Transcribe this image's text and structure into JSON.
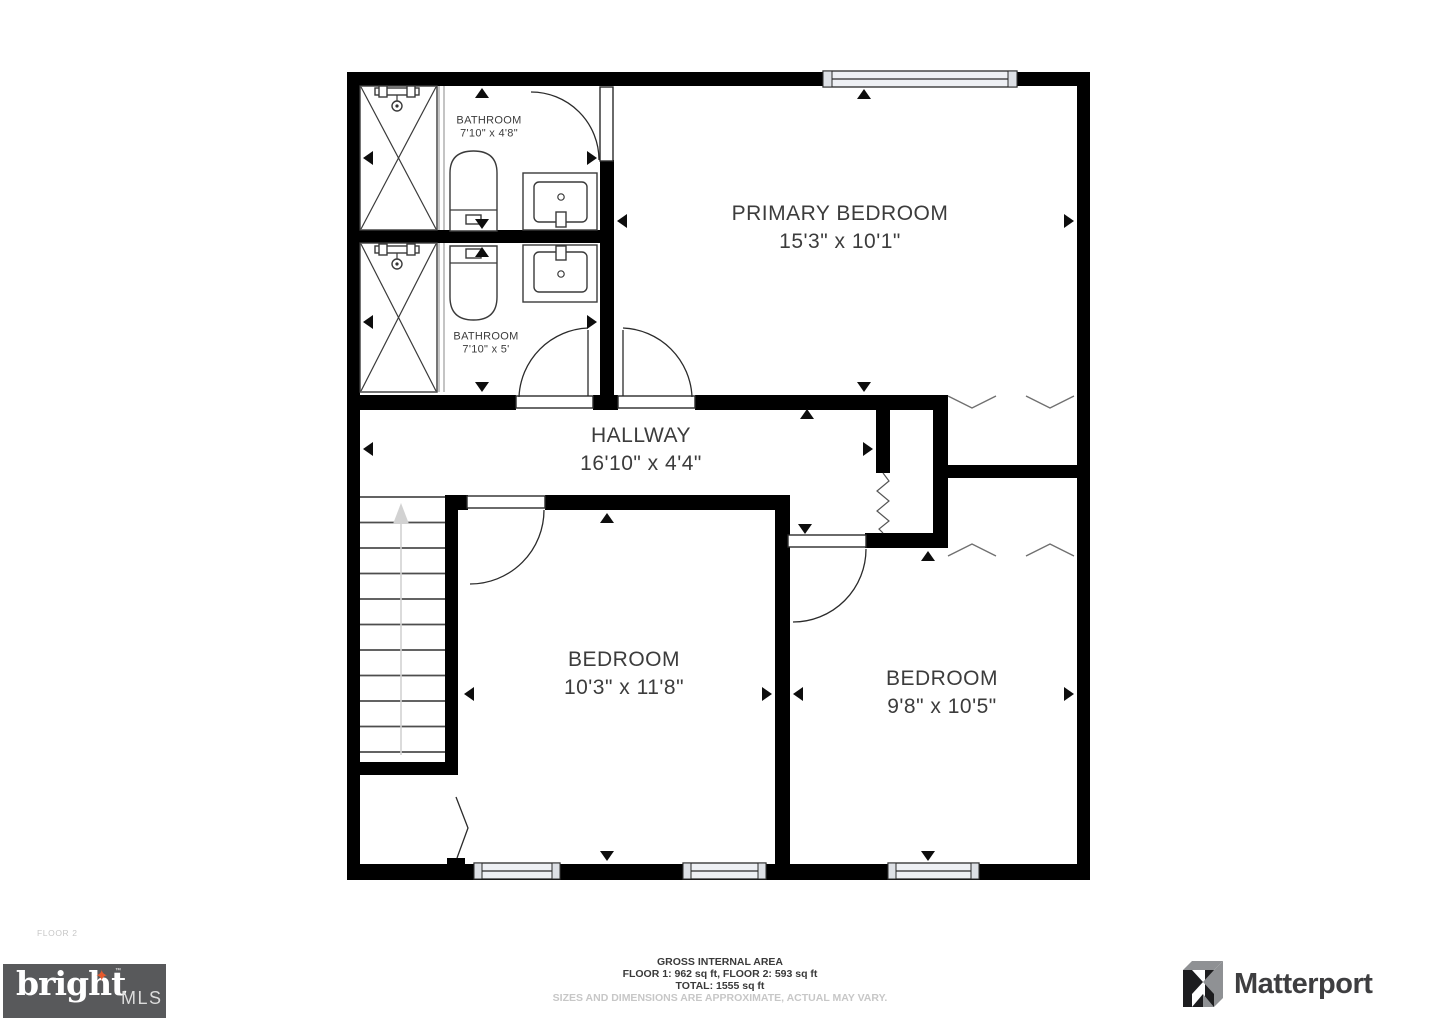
{
  "rooms": {
    "bathroom_1": {
      "name": "BATHROOM",
      "dims": "7'10\" x 4'8\""
    },
    "bathroom_2": {
      "name": "BATHROOM",
      "dims": "7'10\" x 5'"
    },
    "primary_bedroom": {
      "name": "PRIMARY BEDROOM",
      "dims": "15'3\" x 10'1\""
    },
    "hallway": {
      "name": "HALLWAY",
      "dims": "16'10\" x 4'4\""
    },
    "bedroom_1": {
      "name": "BEDROOM",
      "dims": "10'3\" x 11'8\""
    },
    "bedroom_2": {
      "name": "BEDROOM",
      "dims": "9'8\" x 10'5\""
    }
  },
  "floor_label": "FLOOR 2",
  "footer": {
    "gross_area_title": "GROSS INTERNAL AREA",
    "floor_areas": "FLOOR 1: 962 sq ft, FLOOR 2: 593 sq ft",
    "total_area": "TOTAL: 1555 sq ft",
    "disclaimer": "SIZES AND DIMENSIONS ARE APPROXIMATE, ACTUAL MAY VARY."
  },
  "logos": {
    "bright_mls": {
      "brand": "bright",
      "suffix": "MLS",
      "trademark": "™",
      "star_glyph": "✦"
    },
    "matterport": {
      "brand": "Matterport"
    }
  },
  "colors": {
    "wall": "#000000",
    "room_text": "#3c3c3c",
    "footer_text": "#3a3a3a",
    "muted_text": "#c7c7c7",
    "window_fill": "#eef0f4",
    "window_cap": "#dde0e5",
    "stairs_arrow": "#d2d2d2",
    "bright_box": "#58595b",
    "bright_star": "#e65a2d",
    "bright_text": "#ffffff",
    "bright_mls_text": "#dcdcdc",
    "matterport_text": "#3e3e40",
    "matterport_gray": "#8f9194",
    "matterport_black": "#1d1d1f"
  }
}
